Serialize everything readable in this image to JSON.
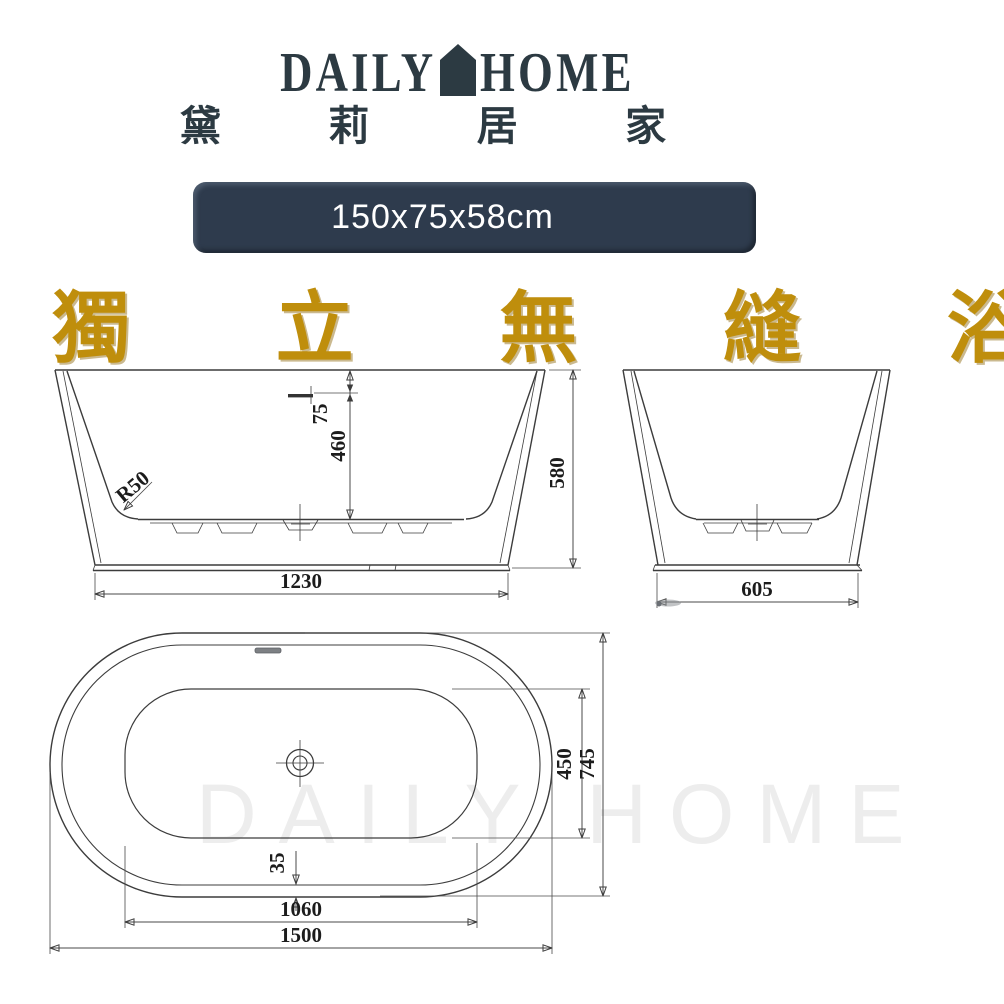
{
  "brand": {
    "word_left": "DAILY",
    "word_right": "HOME",
    "chinese": "黛 莉 居 家",
    "color": "#2c3a42"
  },
  "size_badge": {
    "text": "150x75x58cm",
    "background": "#2e3b4d",
    "text_color": "#ffffff"
  },
  "headline": {
    "text": "獨 立 無 縫 浴 缸",
    "color": "#bf8e0c"
  },
  "watermark": {
    "text": "DAILY HOME",
    "color": "#ededed"
  },
  "dims": {
    "front": {
      "d75": "75",
      "d460": "460",
      "d580": "580",
      "d1230": "1230",
      "r50": "R50"
    },
    "side": {
      "d605": "605"
    },
    "top": {
      "d450": "450",
      "d745": "745",
      "d35": "35",
      "d1060": "1060",
      "d1500": "1500"
    }
  }
}
